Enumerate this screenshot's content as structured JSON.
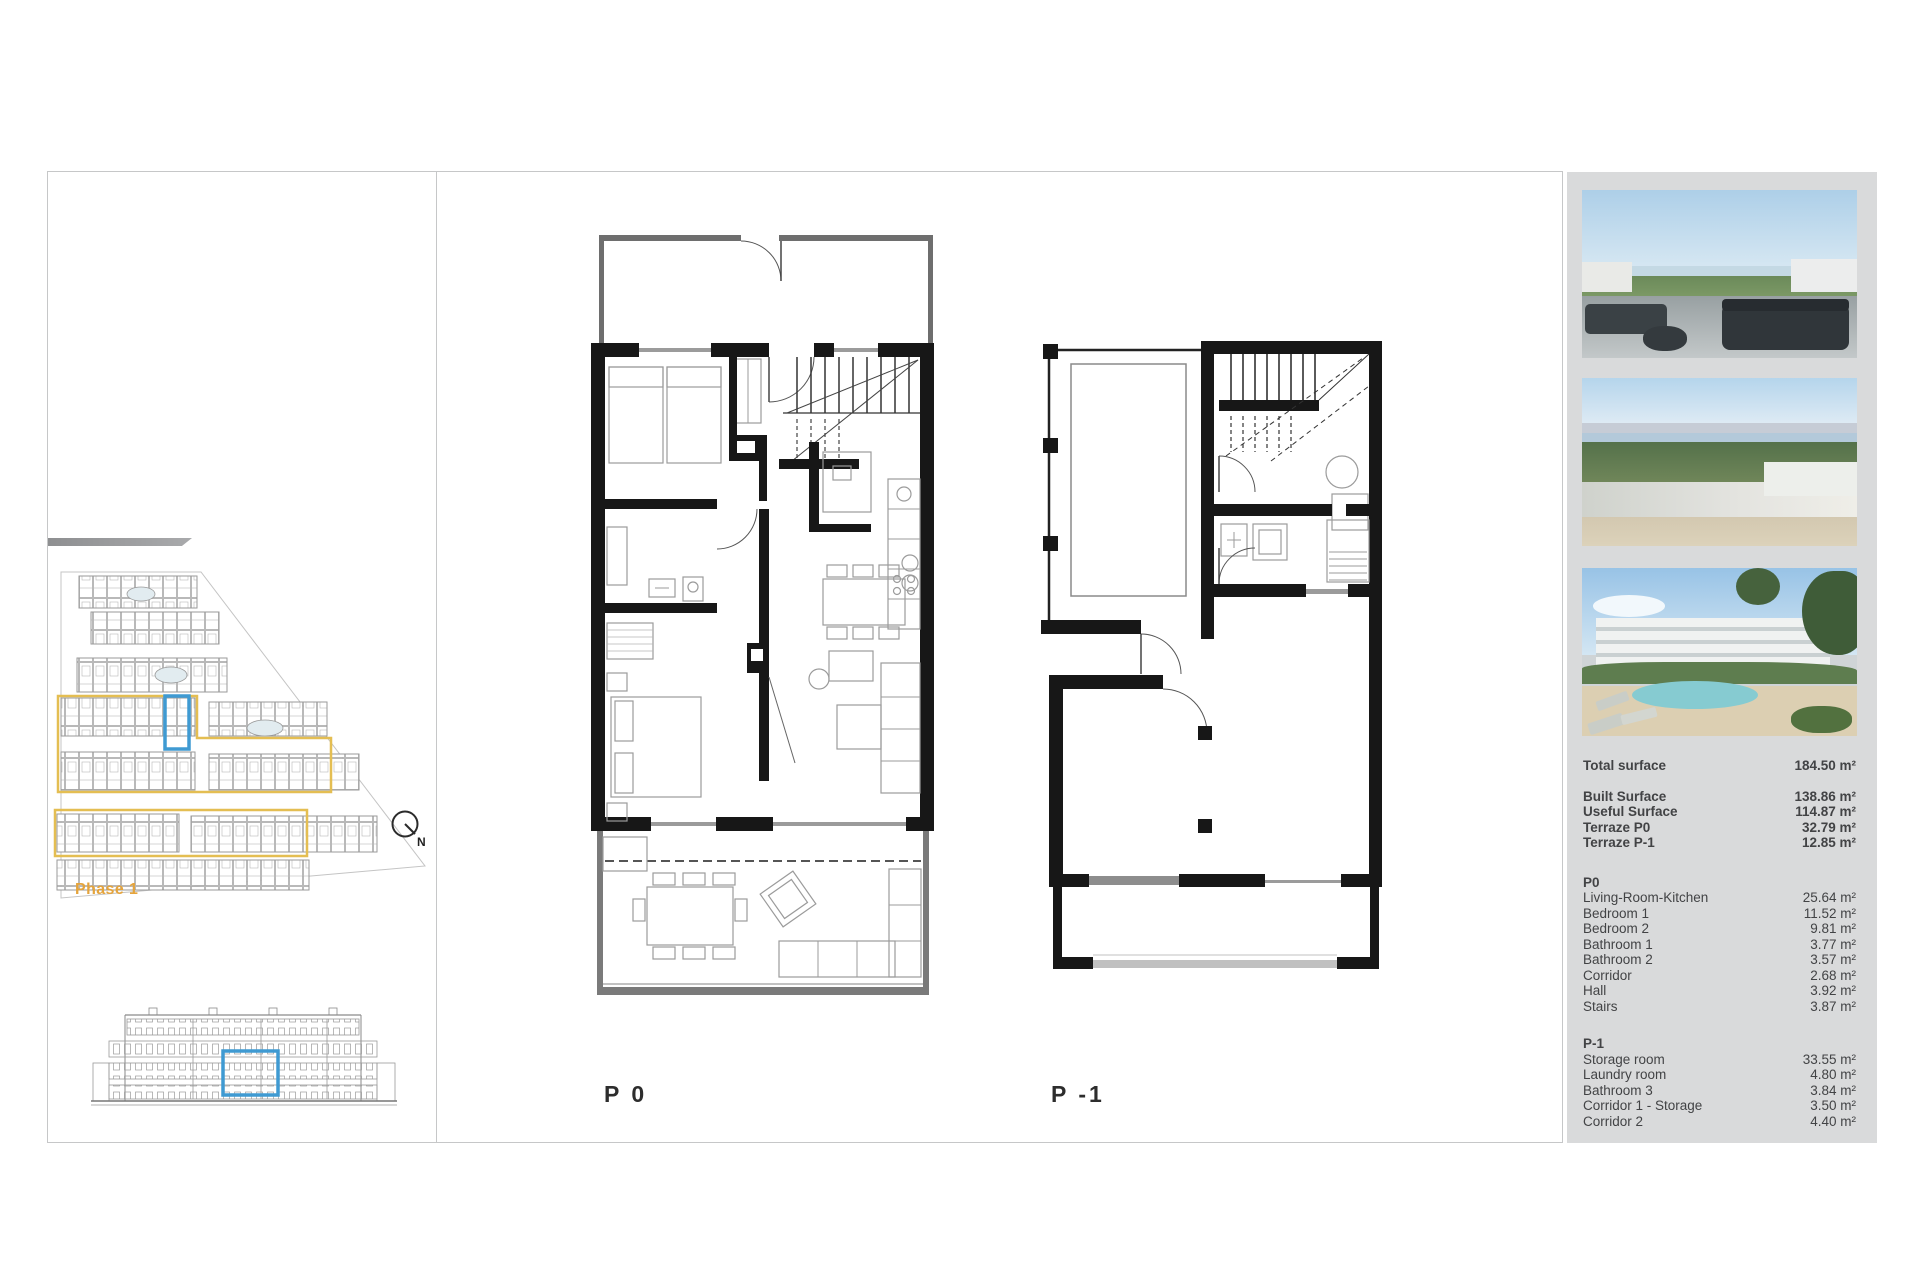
{
  "left_panel": {
    "phase_label": "Phase 1",
    "compass_label": "N"
  },
  "plans": {
    "p0_label": "P 0",
    "p1_label": "P -1"
  },
  "photos": [
    {
      "name": "terrace-view"
    },
    {
      "name": "aerial-view"
    },
    {
      "name": "exterior-pool-view"
    }
  ],
  "summary": {
    "total_row": {
      "label": "Total surface",
      "value": "184.50 m²"
    },
    "rows_secondary": [
      {
        "label": "Built Surface",
        "value": "138.86 m²"
      },
      {
        "label": "Useful Surface",
        "value": "114.87 m²"
      },
      {
        "label": "Terraze P0",
        "value": "32.79 m²"
      },
      {
        "label": "Terraze P-1",
        "value": "12.85 m²"
      }
    ],
    "p0_section": {
      "title": "P0",
      "rows": [
        {
          "label": "Living-Room-Kitchen",
          "value": "25.64 m²"
        },
        {
          "label": "Bedroom 1",
          "value": "11.52 m²"
        },
        {
          "label": "Bedroom 2",
          "value": "9.81 m²"
        },
        {
          "label": "Bathroom 1",
          "value": "3.77 m²"
        },
        {
          "label": "Bathroom 2",
          "value": "3.57 m²"
        },
        {
          "label": "Corridor",
          "value": "2.68 m²"
        },
        {
          "label": "Hall",
          "value": "3.92 m²"
        },
        {
          "label": "Stairs",
          "value": "3.87 m²"
        }
      ]
    },
    "p1_section": {
      "title": "P-1",
      "rows": [
        {
          "label": "Storage room",
          "value": "33.55 m²"
        },
        {
          "label": "Laundry room",
          "value": "4.80 m²"
        },
        {
          "label": "Bathroom 3",
          "value": "3.84 m²"
        },
        {
          "label": "Corridor 1 - Storage",
          "value": "3.50 m²"
        },
        {
          "label": "Corridor 2",
          "value": "4.40 m²"
        }
      ]
    }
  },
  "colors": {
    "panel_bg": "#d9dadb",
    "accent_blue": "#3f9ad2",
    "accent_yellow": "#e4be52",
    "phase_text": "#e5a43c",
    "wall_black": "#171717",
    "text": "#424345"
  }
}
